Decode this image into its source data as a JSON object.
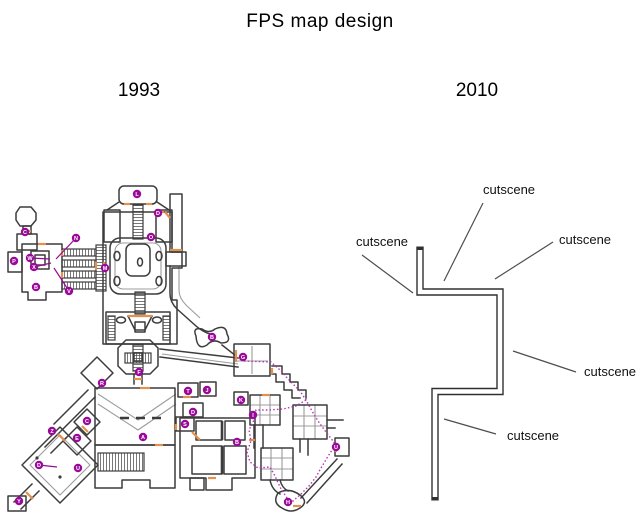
{
  "title": "FPS map design",
  "panels": {
    "left_year": "1993",
    "right_year": "2010"
  },
  "colors": {
    "map_wall": "#3c3c3c",
    "map_inner_lines": "#9c9c9c",
    "map_doors": "#e2914e",
    "map_marker": "#990a99",
    "map_route": "#b535b5",
    "corridor_wall": "#303030",
    "pointer_line": "#4d4d4d"
  },
  "left_map": {
    "markers": [
      {
        "letter": "C",
        "x": 25,
        "y": 232
      },
      {
        "letter": "P",
        "x": 14,
        "y": 261
      },
      {
        "letter": "W",
        "x": 30,
        "y": 258
      },
      {
        "letter": "X",
        "x": 34,
        "y": 267
      },
      {
        "letter": "N",
        "x": 76,
        "y": 238
      },
      {
        "letter": "V",
        "x": 69,
        "y": 291
      },
      {
        "letter": "B",
        "x": 36,
        "y": 287
      },
      {
        "letter": "M",
        "x": 105,
        "y": 268
      },
      {
        "letter": "L",
        "x": 137,
        "y": 194
      },
      {
        "letter": "D",
        "x": 158,
        "y": 213
      },
      {
        "letter": "O",
        "x": 151,
        "y": 237
      },
      {
        "letter": "B",
        "x": 212,
        "y": 337
      },
      {
        "letter": "F",
        "x": 139,
        "y": 372
      },
      {
        "letter": "R",
        "x": 102,
        "y": 383
      },
      {
        "letter": "Z",
        "x": 52,
        "y": 431
      },
      {
        "letter": "C",
        "x": 87,
        "y": 421
      },
      {
        "letter": "E",
        "x": 77,
        "y": 438
      },
      {
        "letter": "D",
        "x": 39,
        "y": 465
      },
      {
        "letter": "U",
        "x": 78,
        "y": 468
      },
      {
        "letter": "Y",
        "x": 19,
        "y": 501
      },
      {
        "letter": "A",
        "x": 143,
        "y": 437
      },
      {
        "letter": "T",
        "x": 188,
        "y": 391
      },
      {
        "letter": "J",
        "x": 207,
        "y": 390
      },
      {
        "letter": "D",
        "x": 193,
        "y": 412
      },
      {
        "letter": "S",
        "x": 185,
        "y": 424
      },
      {
        "letter": "G",
        "x": 243,
        "y": 357
      },
      {
        "letter": "K",
        "x": 241,
        "y": 400
      },
      {
        "letter": "I",
        "x": 253,
        "y": 415
      },
      {
        "letter": "B",
        "x": 237,
        "y": 442
      },
      {
        "letter": "U",
        "x": 336,
        "y": 447
      },
      {
        "letter": "H",
        "x": 288,
        "y": 502
      }
    ],
    "marker_lines": [
      {
        "x1": 76,
        "y1": 238,
        "x2": 56,
        "y2": 259
      },
      {
        "x1": 30,
        "y1": 258,
        "x2": 50,
        "y2": 259
      },
      {
        "x1": 34,
        "y1": 267,
        "x2": 51,
        "y2": 263
      },
      {
        "x1": 69,
        "y1": 291,
        "x2": 54,
        "y2": 268
      },
      {
        "x1": 39,
        "y1": 465,
        "x2": 57,
        "y2": 467
      }
    ],
    "route_paths": [
      "M244,361 L271,362 L280,370 L290,381 L300,391 L306,400 L312,411 L318,421 L326,432 L333,441 L336,447",
      "M306,400 L296,406 L283,409 L268,410 L256,410 L254,420 L249,430 L251,441 L247,452 L250,462 L258,468 L270,467 L275,476 L280,487 L287,498 L293,501 L301,494 L309,486 L316,477 L321,468 L327,458 L332,450 L336,447"
    ]
  },
  "right_diagram": {
    "corridor_outer_path": "M420,246.5 L420,292 L500,292 L500,391.5 L435,391.5 L435,500.5",
    "corridor_inner_path": "M420,250 L420,292 L500,292 L500,391.5 L435,391.5 L435,497",
    "cutscene_labels": [
      {
        "text": "cutscene",
        "x": 483,
        "y": 182,
        "line": {
          "x1": 483,
          "y1": 203,
          "x2": 444,
          "y2": 281
        }
      },
      {
        "text": "cutscene",
        "x": 356,
        "y": 234,
        "line": {
          "x1": 362,
          "y1": 255,
          "x2": 413,
          "y2": 293
        }
      },
      {
        "text": "cutscene",
        "x": 559,
        "y": 232,
        "line": {
          "x1": 553,
          "y1": 242,
          "x2": 495,
          "y2": 279
        }
      },
      {
        "text": "cutscene",
        "x": 584,
        "y": 364,
        "line": {
          "x1": 513,
          "y1": 351,
          "x2": 576,
          "y2": 372
        }
      },
      {
        "text": "cutscene",
        "x": 507,
        "y": 428,
        "line": {
          "x1": 444,
          "y1": 419,
          "x2": 496,
          "y2": 434
        }
      }
    ]
  }
}
